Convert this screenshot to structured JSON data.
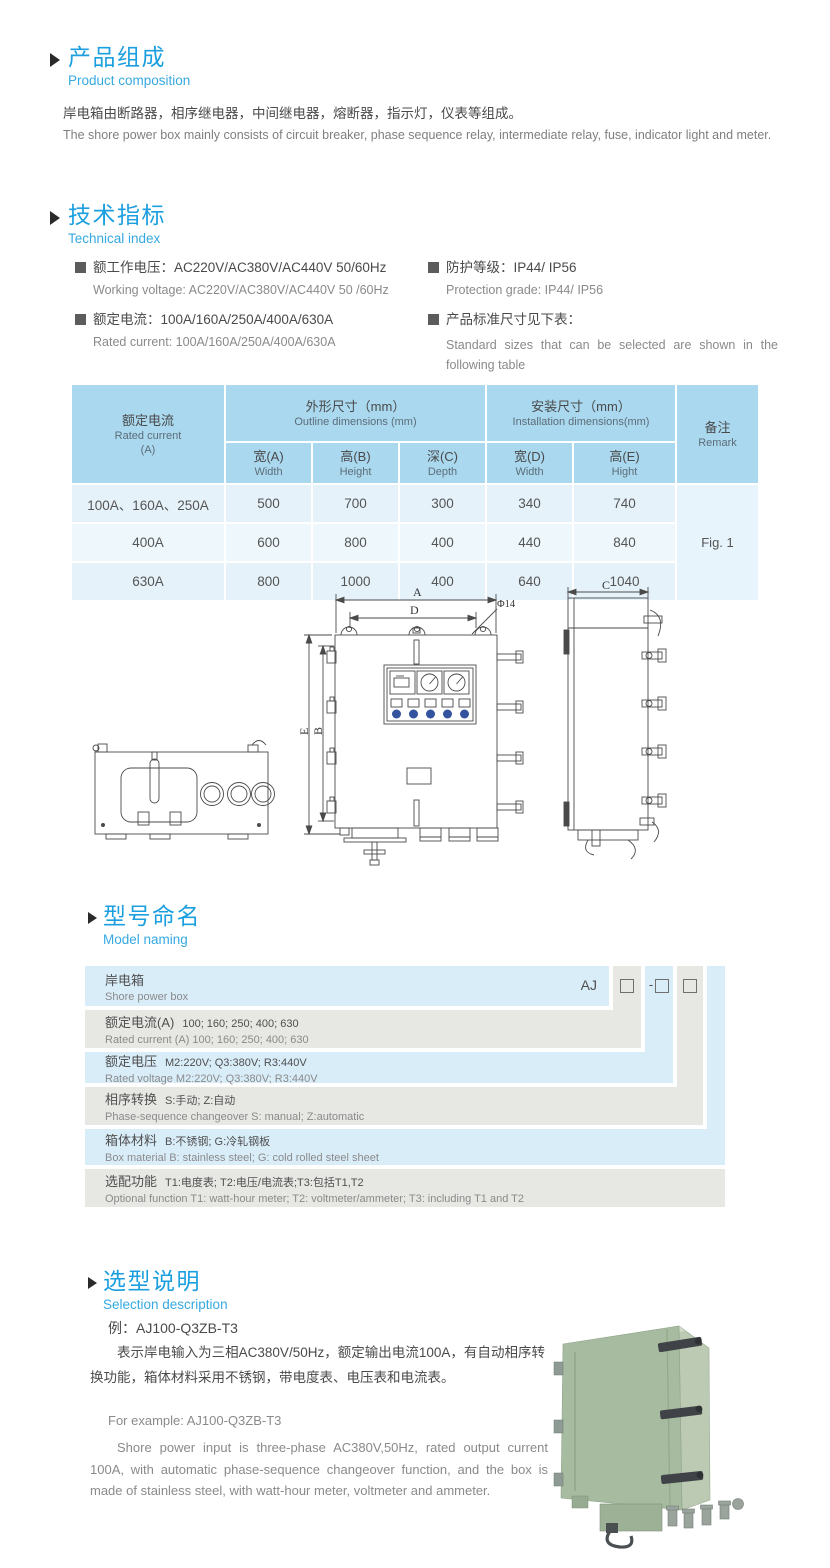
{
  "colors": {
    "accent_blue": "#1c9fdf",
    "subtitle_blue": "#36a9e2",
    "table_header_bg": "#a9d8ef",
    "table_row_light": "#e5f2fa",
    "table_row_lighter": "#eef8fc",
    "model_row_blue": "#d9edf9",
    "model_row_gray": "#e7e7e4",
    "indicator_blue": "#33539e",
    "cabinet_green": "#a6bb9f"
  },
  "composition": {
    "title_cn": "产品组成",
    "title_en": "Product composition",
    "desc_cn": "岸电箱由断路器，相序继电器，中间继电器，熔断器，指示灯，仪表等组成。",
    "desc_en": "The shore power box mainly consists of circuit breaker, phase sequence relay, intermediate relay, fuse, indicator light and meter."
  },
  "tech": {
    "title_cn": "技术指标",
    "title_en": "Technical index",
    "items": [
      {
        "cn": "额工作电压：AC220V/AC380V/AC440V  50/60Hz",
        "en": "Working voltage: AC220V/AC380V/AC440V 50 /60Hz"
      },
      {
        "cn": "额定电流：100A/160A/250A/400A/630A",
        "en": "Rated current: 100A/160A/250A/400A/630A"
      },
      {
        "cn": "防护等级：IP44/ IP56",
        "en": "Protection grade: IP44/ IP56"
      },
      {
        "cn": "产品标准尺寸见下表：",
        "en": "Standard sizes that can be selected are shown in the following table"
      }
    ]
  },
  "size_table": {
    "col_rated_cn": "额定电流",
    "col_rated_en": "Rated current",
    "col_rated_unit": "(A)",
    "grp_outline_cn": "外形尺寸（mm）",
    "grp_outline_en": "Outline dimensions (mm)",
    "grp_install_cn": "安装尺寸（mm）",
    "grp_install_en": "Installation dimensions(mm)",
    "col_remark_cn": "备注",
    "col_remark_en": "Remark",
    "sub": [
      {
        "cn": "宽(A)",
        "en": "Width"
      },
      {
        "cn": "高(B)",
        "en": "Height"
      },
      {
        "cn": "深(C)",
        "en": "Depth"
      },
      {
        "cn": "宽(D)",
        "en": "Width"
      },
      {
        "cn": "高(E)",
        "en": "Hight"
      }
    ],
    "rows": [
      {
        "current": "100A、160A、250A",
        "w": "500",
        "h": "700",
        "d": "300",
        "iw": "340",
        "ih": "740"
      },
      {
        "current": "400A",
        "w": "600",
        "h": "800",
        "d": "400",
        "iw": "440",
        "ih": "840"
      },
      {
        "current": "630A",
        "w": "800",
        "h": "1000",
        "d": "400",
        "iw": "640",
        "ih": "1040"
      }
    ],
    "remark": "Fig. 1"
  },
  "drawing": {
    "labels": {
      "a": "A",
      "d": "D",
      "dia": "Φ14",
      "e": "E",
      "b": "B",
      "c": "C"
    }
  },
  "model_naming": {
    "title_cn": "型号命名",
    "title_en": "Model naming",
    "prefix": "AJ",
    "dash": "-",
    "rows": [
      {
        "cn": "岸电箱",
        "en": "Shore power box"
      },
      {
        "cn": "额定电流(A)",
        "val": "100; 160; 250; 400; 630",
        "en": "Rated current (A) 100; 160; 250; 400; 630"
      },
      {
        "cn": "额定电压",
        "val": "M2:220V;  Q3:380V;  R3:440V",
        "en": "Rated voltage  M2:220V;  Q3:380V;  R3:440V"
      },
      {
        "cn": "相序转换",
        "val": "S:手动; Z:自动",
        "en": "Phase-sequence changeover  S: manual;  Z:automatic"
      },
      {
        "cn": "箱体材料",
        "val": "B:不锈钢;  G:冷轧钢板",
        "en": "Box material   B: stainless steel; G: cold rolled steel sheet"
      },
      {
        "cn": "选配功能",
        "val": "T1:电度表;  T2:电压/电流表;T3:包括T1,T2",
        "en": "Optional function  T1: watt-hour meter; T2: voltmeter/ammeter; T3: including T1 and T2"
      }
    ]
  },
  "selection": {
    "title_cn": "选型说明",
    "title_en": "Selection description",
    "example_cn": "例：AJ100-Q3ZB-T3",
    "desc_cn": "表示岸电输入为三相AC380V/50Hz，额定输出电流100A，有自动相序转换功能，箱体材料采用不锈钢，带电度表、电压表和电流表。",
    "example_en": "For example: AJ100-Q3ZB-T3",
    "desc_en": "Shore power input is three-phase AC380V,50Hz, rated output current 100A, with automatic phase-sequence changeover function, and the box is made of stainless steel, with watt-hour meter, voltmeter and ammeter."
  }
}
